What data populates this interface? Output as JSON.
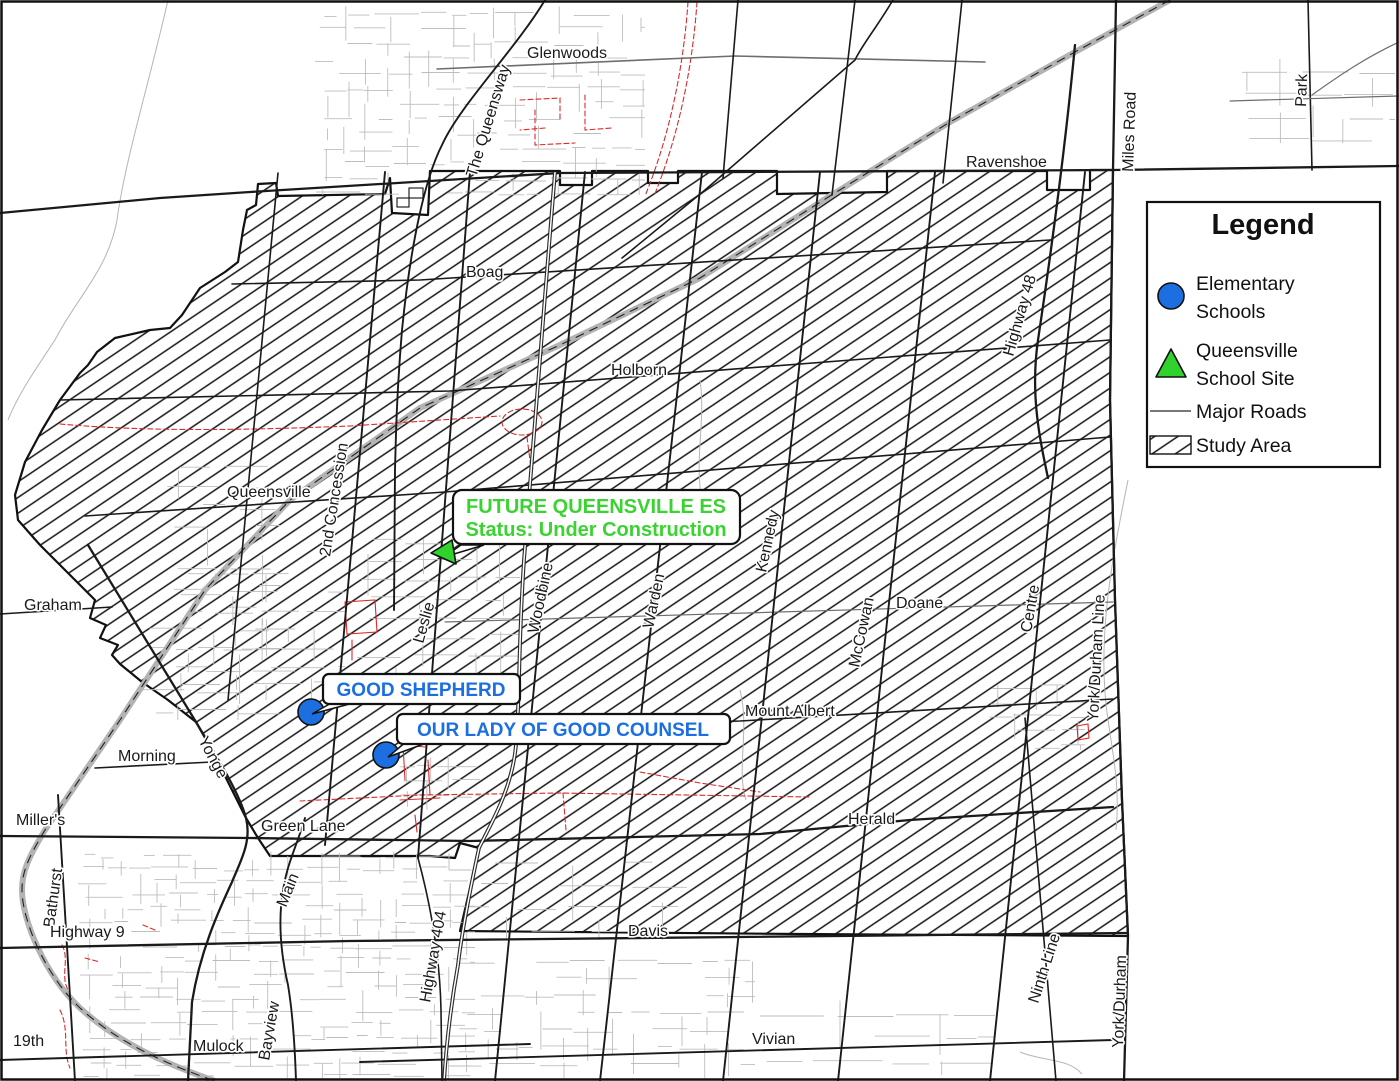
{
  "labels": {
    "glenwoods": "Glenwoods",
    "the_queensway": "The Queensway",
    "ravenshoe": "Ravenshoe",
    "miles_road": "Miles Road",
    "park": "Park",
    "highway_48": "Highway 48",
    "boag": "Boag",
    "holborn": "Holborn",
    "queensville": "Queensville",
    "second_concession": "2nd Concession",
    "graham": "Graham",
    "leslie": "Leslie",
    "woodbine": "Woodbine",
    "warden": "Warden",
    "kennedy": "Kennedy",
    "mccowan": "McCowan",
    "doane": "Doane",
    "centre": "Centre",
    "york_durham_line": "York/Durham Line",
    "mount_albert": "Mount Albert",
    "yonge": "Yonge",
    "morning": "Morning",
    "millers": "Miller's",
    "bathurst": "Bathurst",
    "green_lane": "Green Lane",
    "herald": "Herald",
    "main": "Main",
    "highway_9": "Highway 9",
    "highway_404": "Highway 404",
    "davis": "Davis",
    "mulock": "Mulock",
    "nineteenth": "19th",
    "bayview": "Bayview",
    "vivian": "Vivian",
    "ninth_line": "Ninth Line",
    "york_durham": "York/Durham"
  },
  "callouts": {
    "future": {
      "line1": "FUTURE QUEENSVILLE ES",
      "line2": "Status: Under Construction"
    },
    "good_shepherd": "GOOD SHEPHERD",
    "our_lady": "OUR LADY OF GOOD COUNSEL"
  },
  "legend": {
    "title": "Legend",
    "elementary_line1": "Elementary",
    "elementary_line2": "Schools",
    "site_line1": "Queensville",
    "site_line2": "School Site",
    "major_roads": "Major Roads",
    "study_area": "Study Area"
  },
  "colors": {
    "blue": "#1b6fe0",
    "green": "#2fd32c",
    "greentext": "#3bd331",
    "red": "#d92b2b",
    "rail": "#b3b3b3"
  }
}
